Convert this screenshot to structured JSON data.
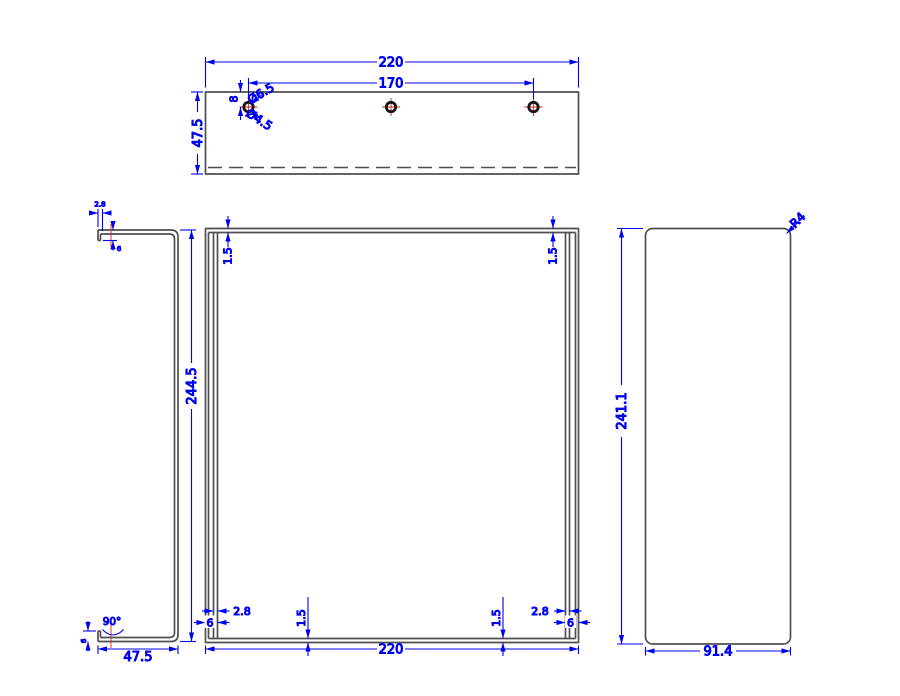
{
  "title": "CAD multi-view technical drawing of sheet-metal bracket",
  "colors": {
    "dimension": "#0000f0",
    "object_line": "#4f4f4f",
    "centerline": "#dd2222",
    "hole_ring": "#161616",
    "background": "#ffffff"
  },
  "top_view": {
    "width": "220",
    "hole_spacing": "170",
    "depth": "47.5",
    "hole_edge_offset": "8",
    "hole_dia_outer": "Ø6.5",
    "hole_dia_inner": "Ø4.5"
  },
  "front_view": {
    "width": "220",
    "wall_top_left": "1.5",
    "wall_top_right": "1.5",
    "lip_gap_left": "2.8",
    "lip_gap_right": "2.8",
    "lip_width_left": "6",
    "lip_width_right": "6",
    "wall_bottom_left": "1.5",
    "wall_bottom_right": "1.5"
  },
  "side_view": {
    "height": "244.5",
    "depth": "47.5",
    "bend_angle": "90°",
    "lip_offset": "2.8",
    "lip_length_top": "6",
    "lip_length_bottom": "6"
  },
  "flat_view": {
    "height": "241.1",
    "width": "91.4",
    "corner_radius": "R4"
  }
}
